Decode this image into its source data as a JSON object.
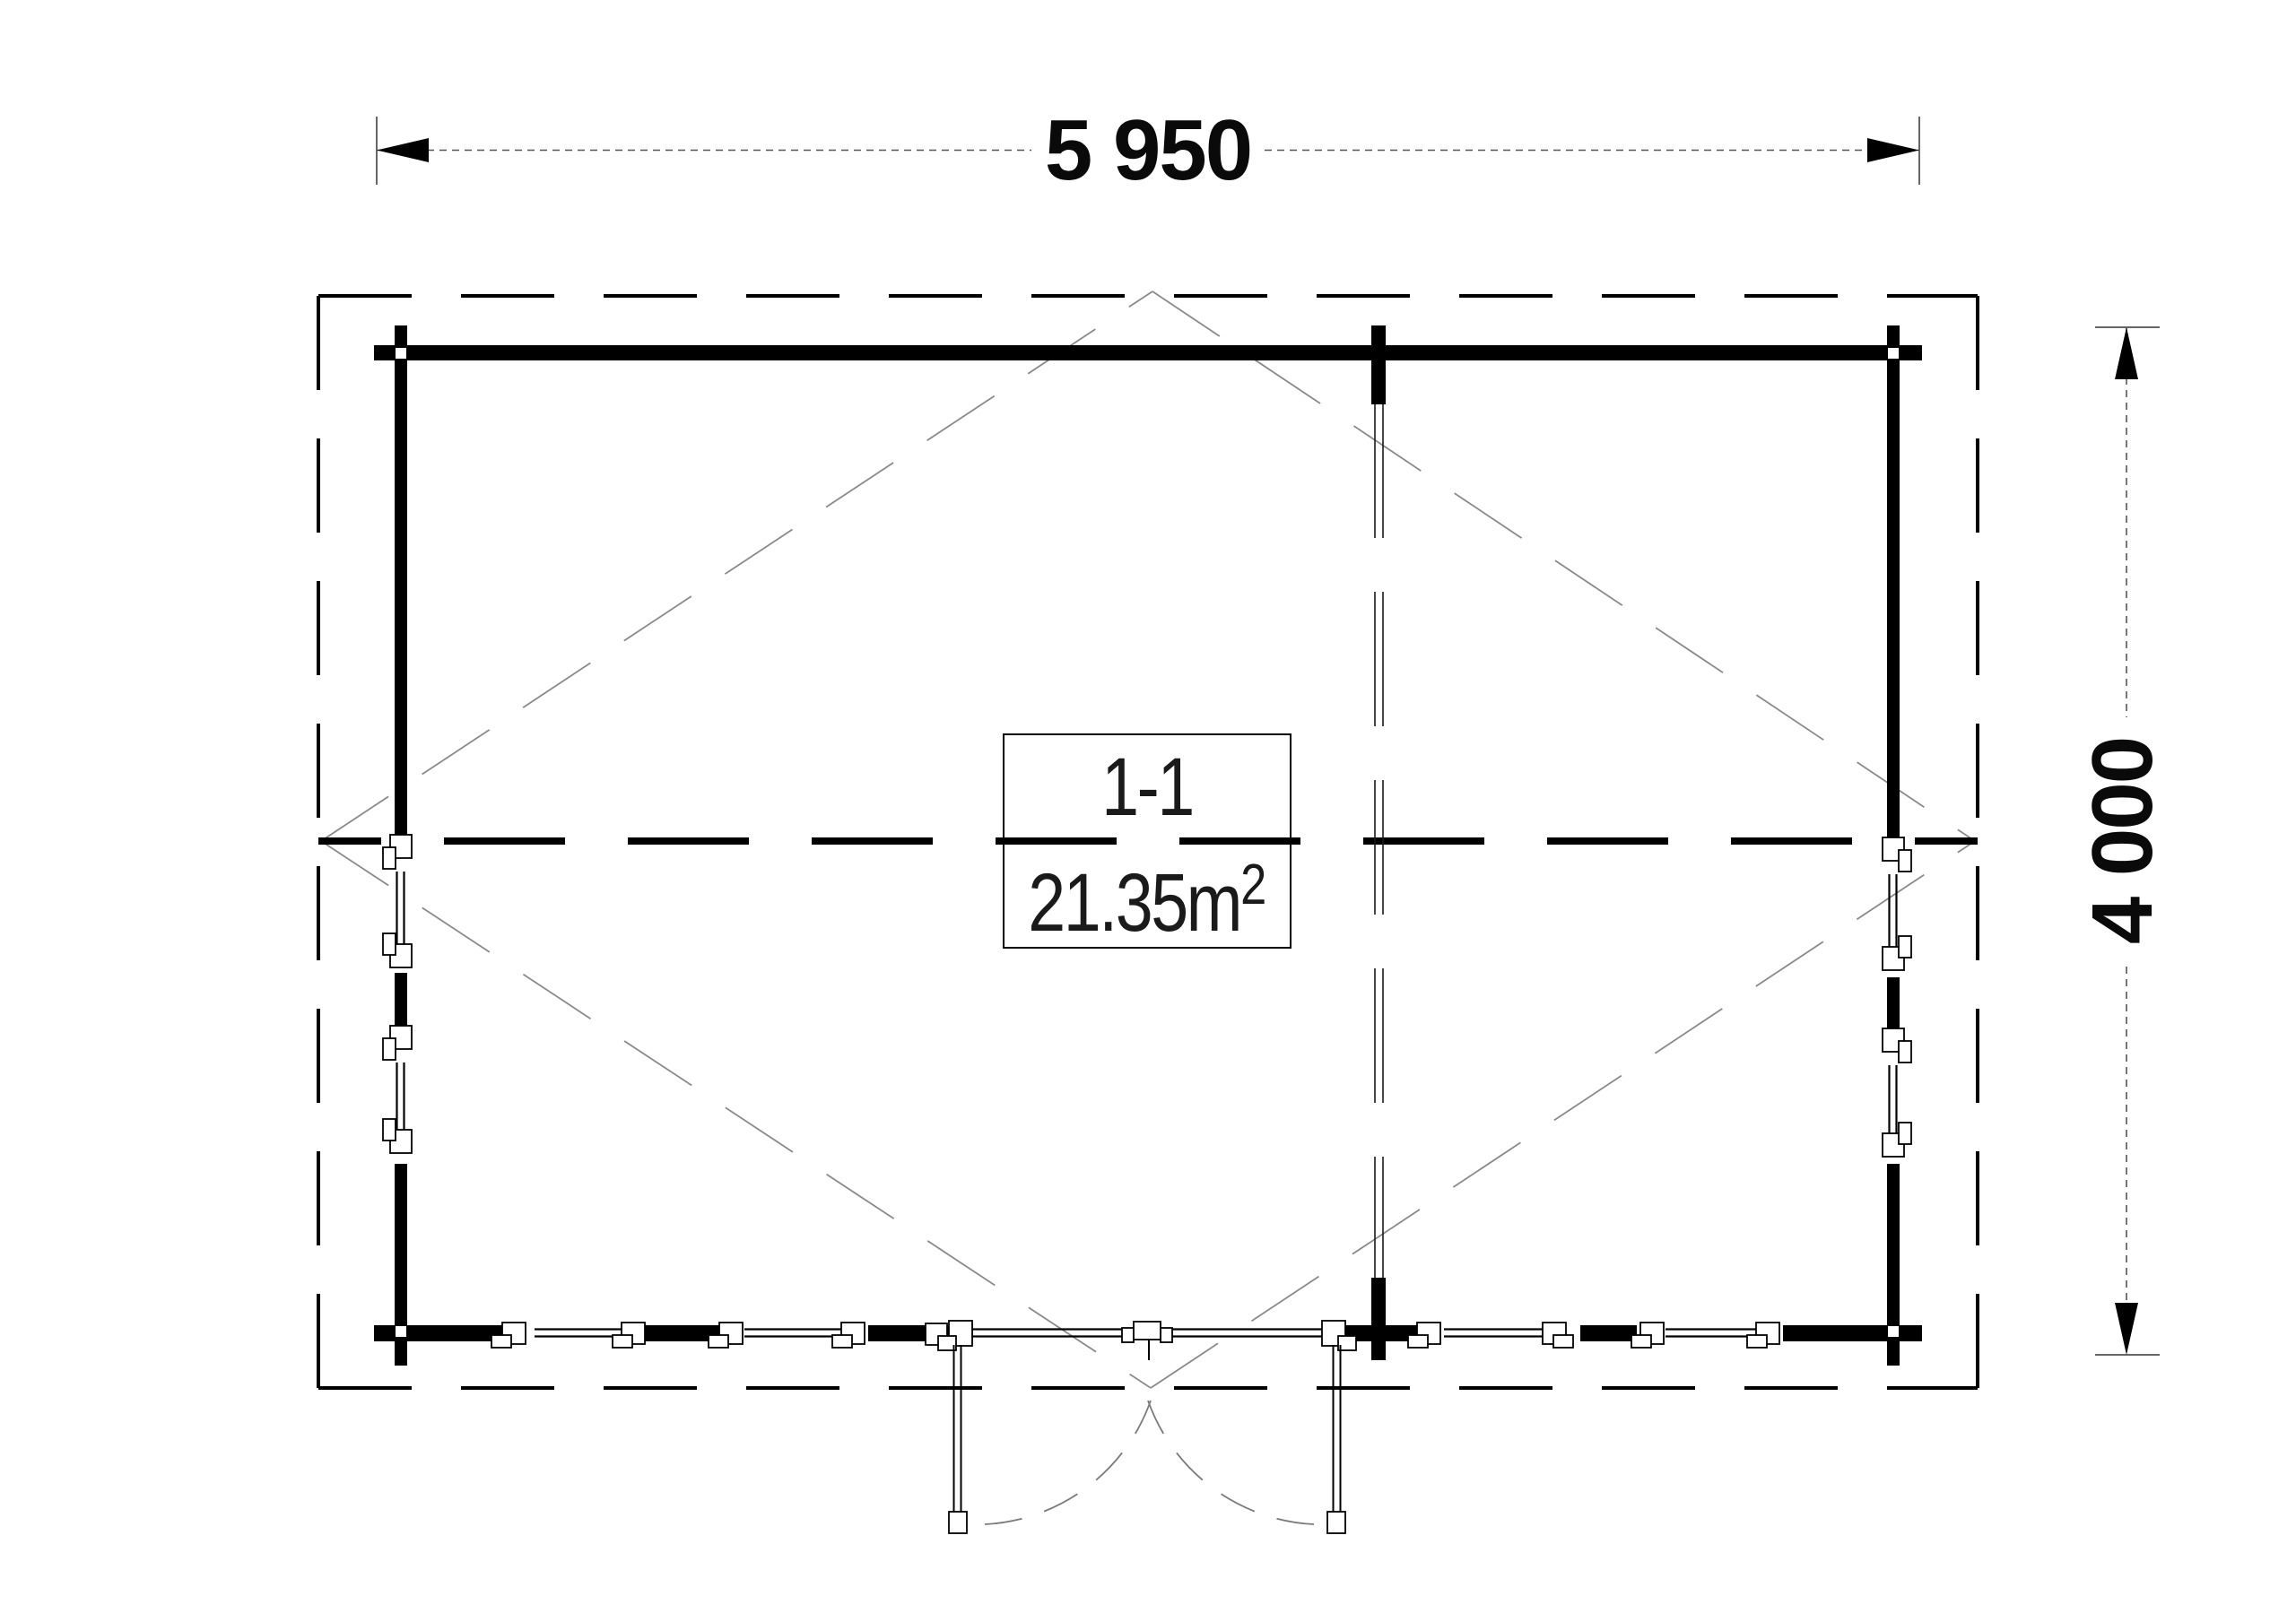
{
  "dimensions": {
    "width": {
      "value": "5 950"
    },
    "height": {
      "value": "4 000"
    }
  },
  "room": {
    "name": "1-1",
    "area_base": "21.35m",
    "area_exponent": "2"
  },
  "colors": {
    "background": "#ffffff",
    "wall": "#000000",
    "roof_dash": "#000000",
    "thin_line": "#1a1a1a",
    "diagonal_line": "#8a8a8a",
    "dimension_line": "#555555"
  }
}
